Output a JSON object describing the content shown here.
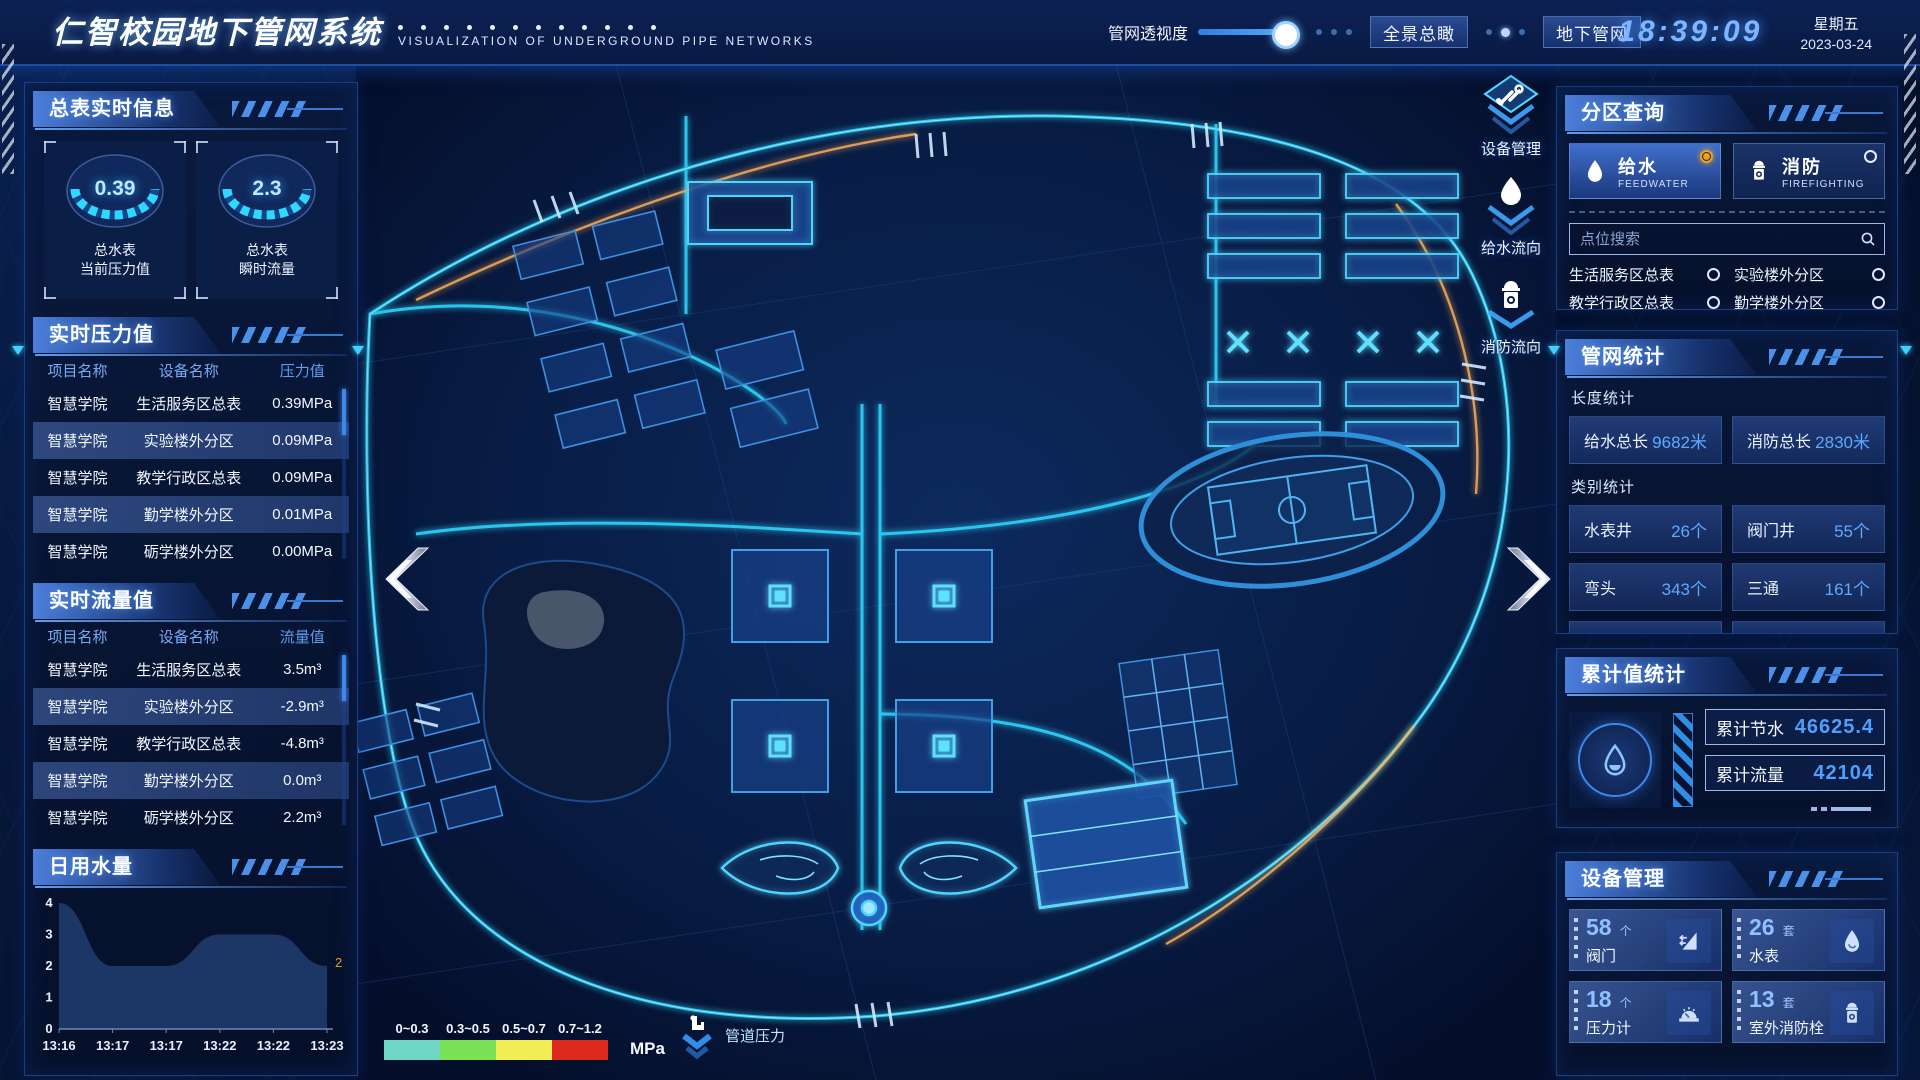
{
  "header": {
    "title": "仁智校园地下管网系统",
    "subtitle": "VISUALIZATION OF UNDERGROUND PIPE NETWORKS",
    "opacity_slider_label": "管网透视度",
    "btn_overview": "全景总瞰",
    "btn_underground": "地下管网",
    "time": "18:39:09",
    "weekday": "星期五",
    "date": "2023-03-24"
  },
  "left": {
    "meter_info": {
      "title": "总表实时信息",
      "gauges": [
        {
          "value": "0.39",
          "line1": "总水表",
          "line2": "当前压力值"
        },
        {
          "value": "2.3",
          "line1": "总水表",
          "line2": "瞬时流量"
        }
      ]
    },
    "pressure": {
      "title": "实时压力值",
      "headers": [
        "项目名称",
        "设备名称",
        "压力值"
      ],
      "rows": [
        [
          "智慧学院",
          "生活服务区总表",
          "0.39MPa"
        ],
        [
          "智慧学院",
          "实验楼外分区",
          "0.09MPa"
        ],
        [
          "智慧学院",
          "教学行政区总表",
          "0.09MPa"
        ],
        [
          "智慧学院",
          "勤学楼外分区",
          "0.01MPa"
        ],
        [
          "智慧学院",
          "砺学楼外分区",
          "0.00MPa"
        ]
      ]
    },
    "flow": {
      "title": "实时流量值",
      "headers": [
        "项目名称",
        "设备名称",
        "流量值"
      ],
      "rows": [
        [
          "智慧学院",
          "生活服务区总表",
          "3.5m³"
        ],
        [
          "智慧学院",
          "实验楼外分区",
          "-2.9m³"
        ],
        [
          "智慧学院",
          "教学行政区总表",
          "-4.8m³"
        ],
        [
          "智慧学院",
          "勤学楼外分区",
          "0.0m³"
        ],
        [
          "智慧学院",
          "砺学楼外分区",
          "2.2m³"
        ]
      ]
    },
    "daily_water": {
      "title": "日用水量",
      "chart": {
        "type": "area",
        "x": [
          "13:16",
          "13:17",
          "13:17",
          "13:22",
          "13:22",
          "13:23"
        ],
        "values": [
          4,
          2,
          2,
          3,
          3,
          2
        ],
        "ylim": [
          0,
          4
        ],
        "yticks": [
          0,
          1,
          2,
          3,
          4
        ],
        "end_label": "2",
        "end_label_color": "#d7a11f",
        "area_color": "#1e3a69"
      }
    }
  },
  "map": {
    "overlay_buttons": [
      {
        "label": "设备管理",
        "icon": "tools-icon"
      },
      {
        "label": "给水流向",
        "icon": "water-drop-icon"
      },
      {
        "label": "消防流向",
        "icon": "hydrant-icon"
      }
    ],
    "legend": {
      "ranges": [
        {
          "label": "0~0.3",
          "color": "#6fd6c6"
        },
        {
          "label": "0.3~0.5",
          "color": "#79e355"
        },
        {
          "label": "0.5~0.7",
          "color": "#f1ee55"
        },
        {
          "label": "0.7~1.2",
          "color": "#dd2a1f"
        }
      ],
      "unit": "MPa",
      "caption": "管道压力",
      "caption_icon": "pipeline-pressure-icon"
    }
  },
  "right": {
    "zone_query": {
      "title": "分区查询",
      "tabs": [
        {
          "label": "给水",
          "sub": "FEEDWATER",
          "icon": "water-drop-icon",
          "selected": true
        },
        {
          "label": "消防",
          "sub": "FIREFIGHTING",
          "icon": "hydrant-icon",
          "selected": false
        }
      ],
      "search_placeholder": "点位搜索",
      "points": [
        "生活服务区总表",
        "实验楼外分区",
        "教学行政区总表",
        "勤学楼外分区",
        "砺学楼外分区",
        "宿舍区泵房"
      ]
    },
    "pipe_stats": {
      "title": "管网统计",
      "length_title": "长度统计",
      "length_items": [
        {
          "label": "给水总长",
          "value": "9682米"
        },
        {
          "label": "消防总长",
          "value": "2830米"
        }
      ],
      "category_title": "类别统计",
      "category_items": [
        {
          "label": "水表井",
          "value": "26个"
        },
        {
          "label": "阀门井",
          "value": "55个"
        },
        {
          "label": "弯头",
          "value": "343个"
        },
        {
          "label": "三通",
          "value": "161个"
        }
      ]
    },
    "accumulated": {
      "title": "累计值统计",
      "icon": "water-drop-icon",
      "items": [
        {
          "label": "累计节水",
          "value": "46625.4"
        },
        {
          "label": "累计流量",
          "value": "42104"
        }
      ]
    },
    "devices": {
      "title": "设备管理",
      "items": [
        {
          "count": "58",
          "unit": "个",
          "label": "阀门",
          "icon": "valve-icon"
        },
        {
          "count": "26",
          "unit": "套",
          "label": "水表",
          "icon": "water-meter-icon"
        },
        {
          "count": "18",
          "unit": "个",
          "label": "压力计",
          "icon": "pressure-gauge-icon"
        },
        {
          "count": "13",
          "unit": "套",
          "label": "室外消防栓",
          "icon": "outdoor-hydrant-icon"
        }
      ]
    }
  },
  "colors": {
    "accent_cyan": "#38d6ff",
    "selected_radio_orange": "#f0a21f",
    "value_blue": "#5fa8ff",
    "road_glow": "#2fd8ff",
    "warm_accent": "#ffb35c"
  }
}
